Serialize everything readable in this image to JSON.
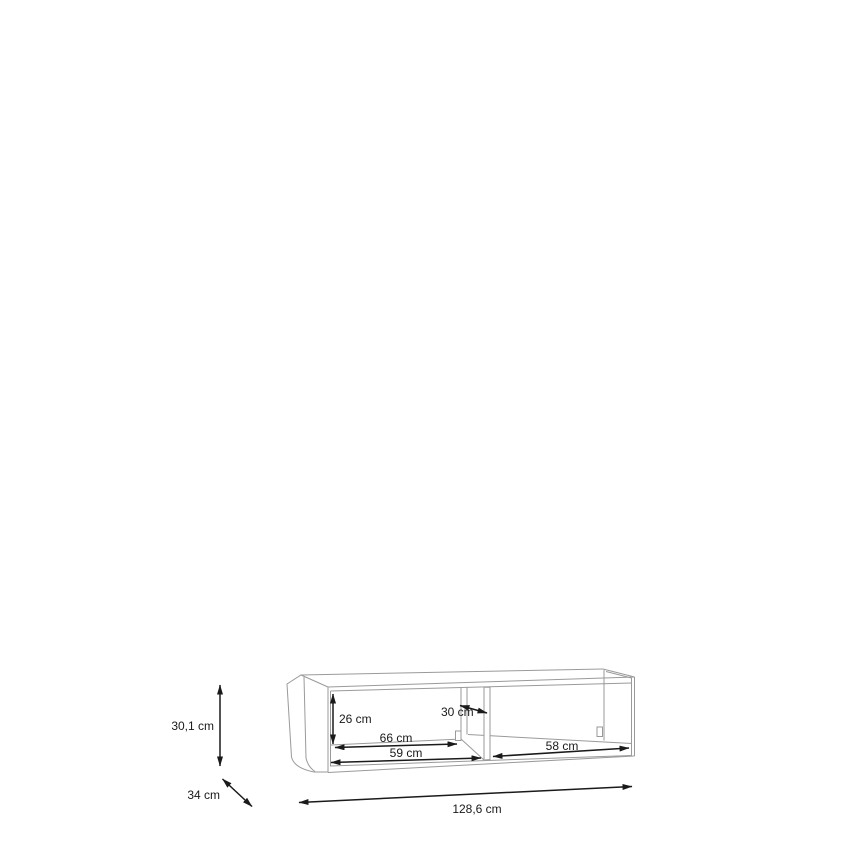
{
  "diagram": {
    "labels": {
      "height": "30,1 cm",
      "depth": "34 cm",
      "inner_height": "26 cm",
      "left_back_width": "66 cm",
      "left_front_width": "59 cm",
      "inner_depth": "30 cm",
      "right_width": "58 cm",
      "total_width": "128,6 cm"
    },
    "colors": {
      "background": "#ffffff",
      "furniture_line": "#9a9a9a",
      "dimension_line": "#1a1a1a",
      "label_text": "#1a1a1a"
    }
  }
}
